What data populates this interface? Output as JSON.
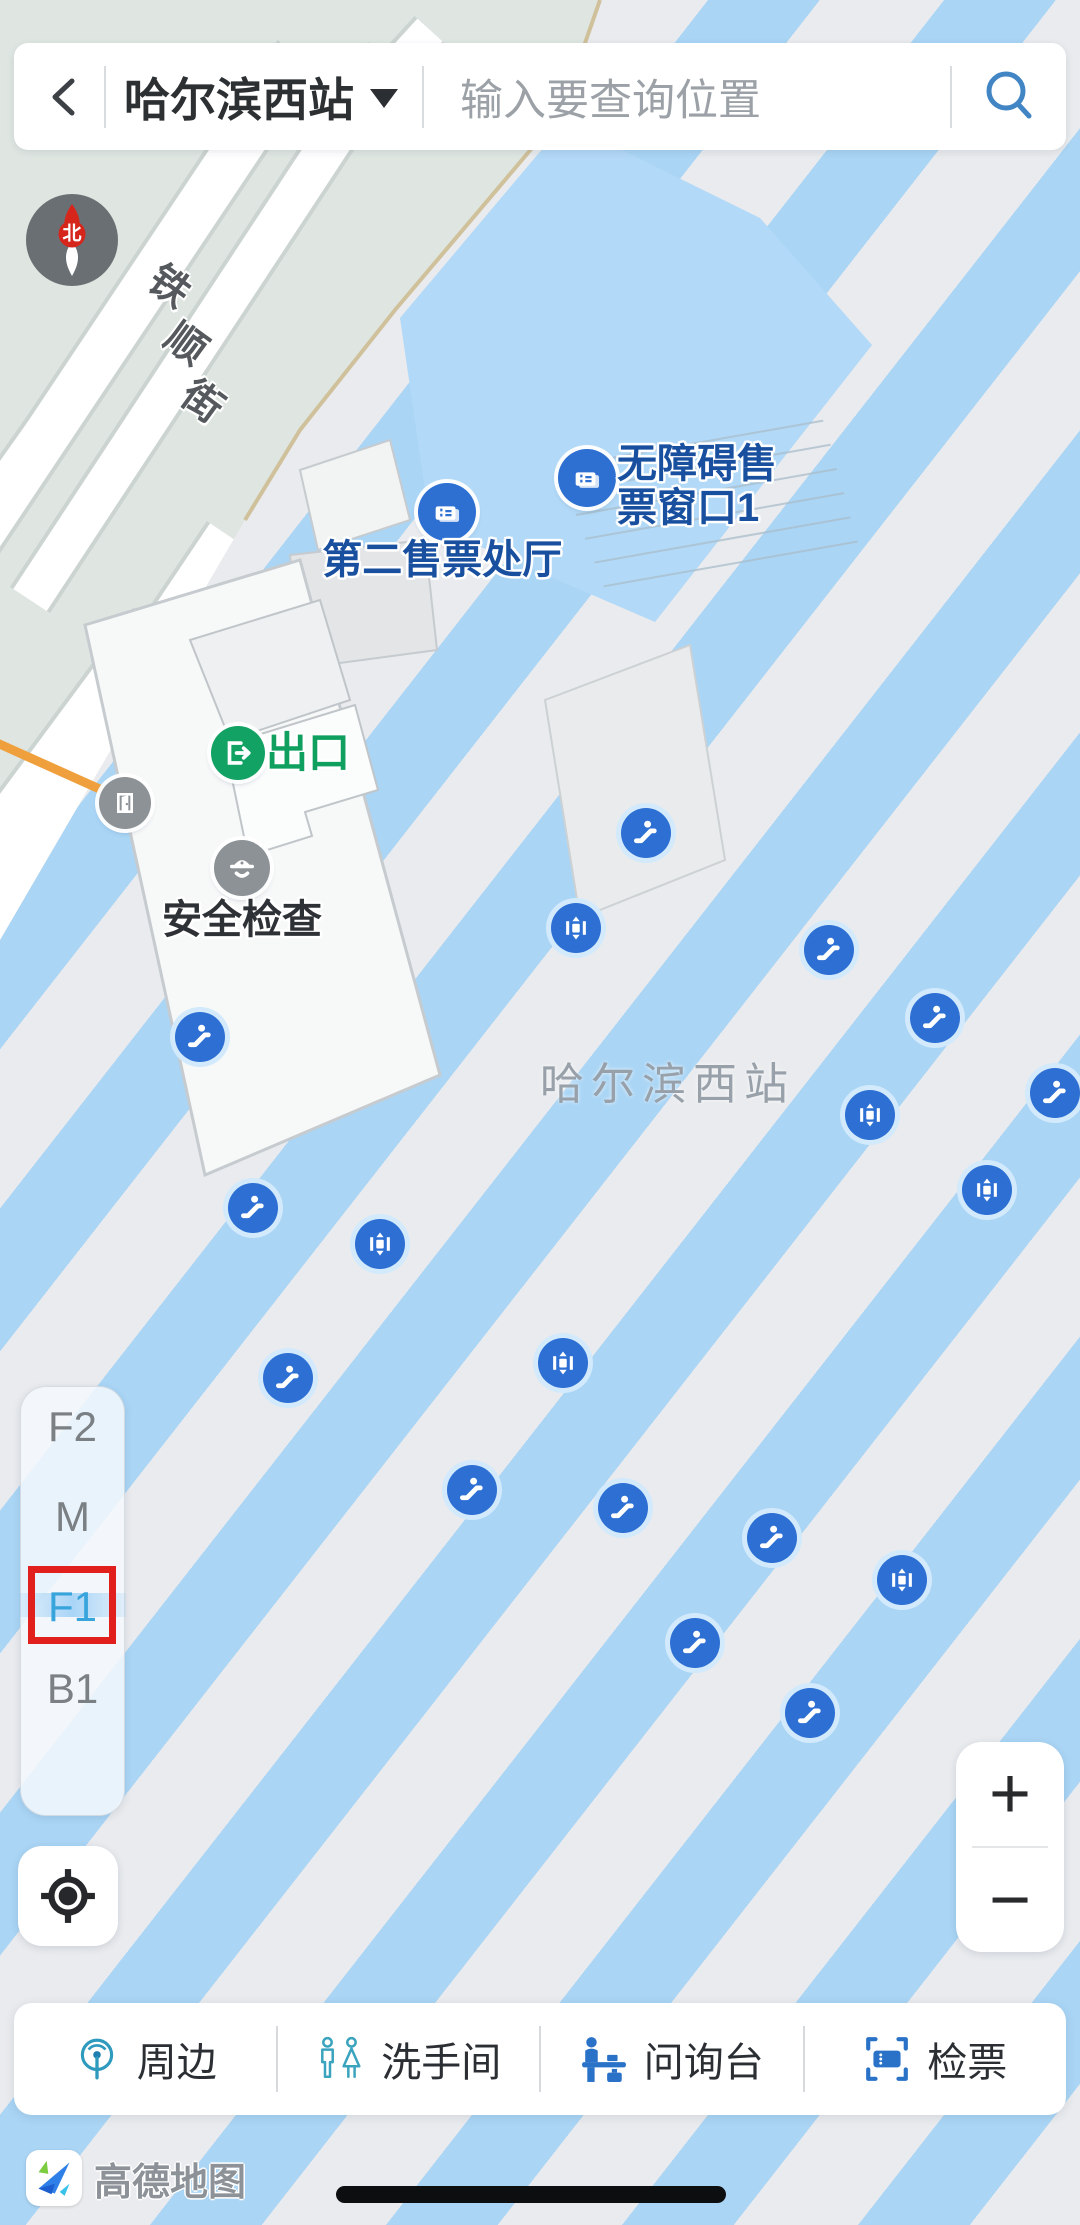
{
  "app": {
    "logo_text": "高德地图"
  },
  "header": {
    "station_selector": "哈尔滨西站",
    "search_placeholder": "输入要查询位置"
  },
  "map": {
    "watermark": "哈尔滨西站",
    "compass_north": "北",
    "street_label": "铁顺街",
    "street_label_chars": [
      "铁",
      "顺",
      "街"
    ],
    "pois": [
      {
        "id": "accessible_ticket_window",
        "icon": "ticket-window-icon",
        "label_lines": [
          "无障碍售",
          "票窗口1"
        ],
        "x": 587,
        "y": 478
      },
      {
        "id": "second_ticket_hall",
        "icon": "ticket-window-icon",
        "label": "第二售票处厅",
        "x": 447,
        "y": 512
      },
      {
        "id": "exit",
        "icon": "exit-icon",
        "label": "出口",
        "x": 238,
        "y": 753
      },
      {
        "id": "security_check",
        "icon": "security-icon",
        "label": "安全检查",
        "x": 242,
        "y": 868
      },
      {
        "id": "door",
        "icon": "door-icon",
        "x": 125,
        "y": 803
      }
    ],
    "facilities": [
      {
        "type": "escalator",
        "x": 646,
        "y": 833
      },
      {
        "type": "elevator",
        "x": 576,
        "y": 928
      },
      {
        "type": "escalator",
        "x": 829,
        "y": 950
      },
      {
        "type": "escalator",
        "x": 935,
        "y": 1018
      },
      {
        "type": "escalator",
        "x": 200,
        "y": 1037
      },
      {
        "type": "escalator",
        "x": 1055,
        "y": 1093
      },
      {
        "type": "elevator",
        "x": 870,
        "y": 1115
      },
      {
        "type": "elevator",
        "x": 987,
        "y": 1190
      },
      {
        "type": "escalator",
        "x": 253,
        "y": 1208
      },
      {
        "type": "elevator",
        "x": 380,
        "y": 1244
      },
      {
        "type": "elevator",
        "x": 563,
        "y": 1363
      },
      {
        "type": "escalator",
        "x": 288,
        "y": 1378
      },
      {
        "type": "escalator",
        "x": 472,
        "y": 1490
      },
      {
        "type": "escalator",
        "x": 623,
        "y": 1508
      },
      {
        "type": "escalator",
        "x": 772,
        "y": 1538
      },
      {
        "type": "elevator",
        "x": 902,
        "y": 1580
      },
      {
        "type": "escalator",
        "x": 695,
        "y": 1643
      },
      {
        "type": "escalator",
        "x": 810,
        "y": 1713
      }
    ]
  },
  "floor_selector": {
    "floors": [
      {
        "label": "F2",
        "selected": false
      },
      {
        "label": "M",
        "selected": false
      },
      {
        "label": "F1",
        "selected": true,
        "annotated": true
      },
      {
        "label": "B1",
        "selected": false
      }
    ]
  },
  "controls": {
    "zoom_in": "+",
    "zoom_out": "−"
  },
  "toolbar": {
    "items": [
      {
        "label": "周边",
        "icon": "nearby-icon"
      },
      {
        "label": "洗手间",
        "icon": "restroom-icon"
      },
      {
        "label": "问询台",
        "icon": "information-desk-icon"
      },
      {
        "label": "检票",
        "icon": "ticket-check-icon"
      }
    ]
  },
  "colors": {
    "stripe_blue": "#aad5f5",
    "stripe_gray": "#e9ebee",
    "ground_green": "#dfe6e2",
    "hall_blue": "#b2d9f7",
    "facility_blue": "#2d6fd3",
    "poi_text_blue": "#184f9f",
    "exit_green": "#11a264",
    "annotation_red": "#e1201e",
    "floor_selected_blue": "#37a4db",
    "toolbar_icon_blue": "#2a72c8",
    "search_icon_blue": "#4285c4"
  }
}
